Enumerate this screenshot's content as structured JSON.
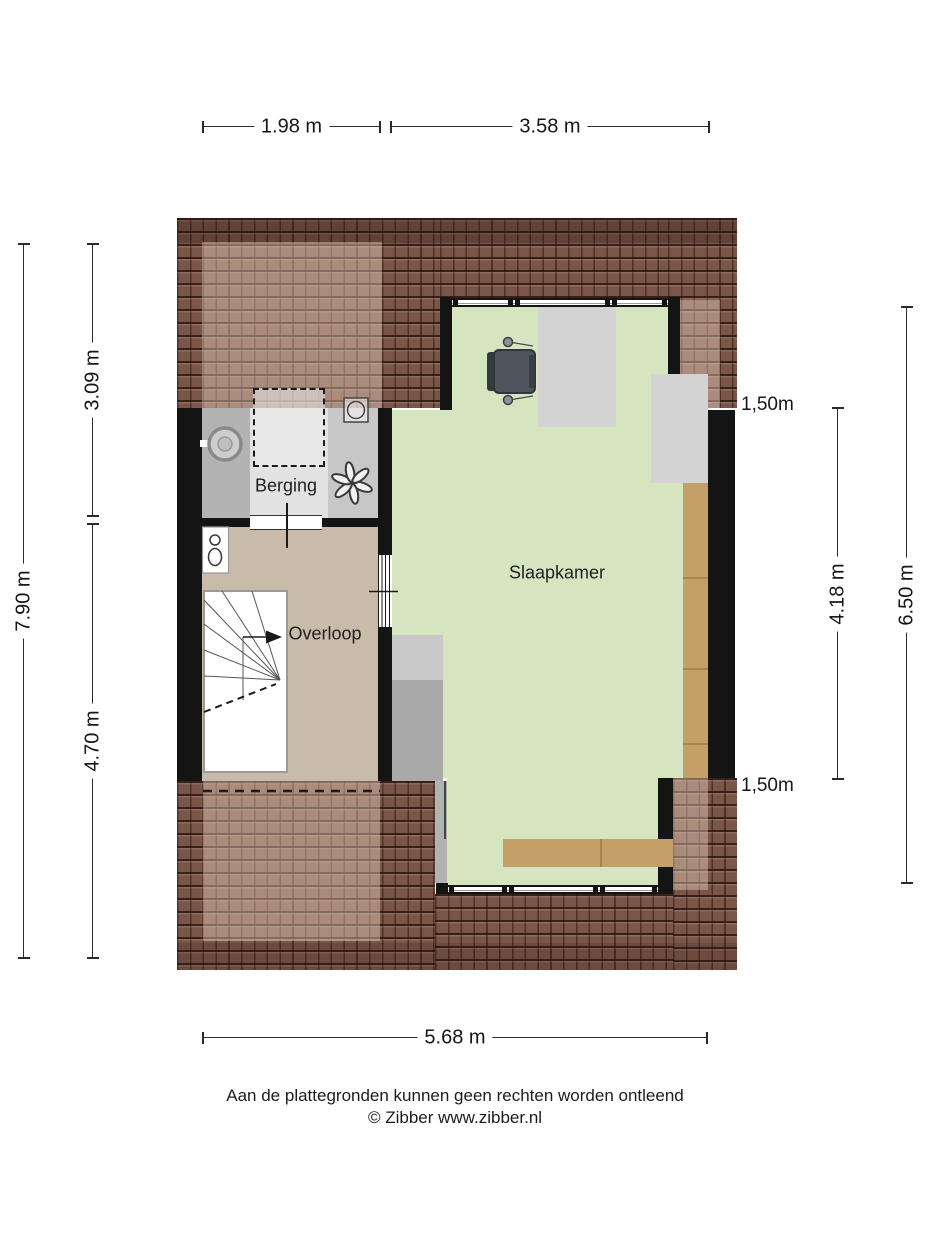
{
  "plan": {
    "type": "floorplan-second-floor",
    "rooms": [
      {
        "id": "berging",
        "label": "Berging"
      },
      {
        "id": "overloop",
        "label": "Overloop"
      },
      {
        "id": "slaapkamer",
        "label": "Slaapkamer"
      }
    ],
    "fixtures": [
      "washing-machine",
      "storage-hatch-dashed",
      "mechanical-ventilation-fan",
      "boiler-unit",
      "toilet",
      "winder-staircase",
      "stair-direction-arrow",
      "office-chair",
      "wardrobe",
      "desk",
      "dormer-window-top",
      "dormer-window-bottom",
      "interior-glass-door",
      "headroom-dashed-line"
    ]
  },
  "dimensions": {
    "top": [
      {
        "label": "1.98 m"
      },
      {
        "label": "3.58 m"
      }
    ],
    "left": [
      {
        "label": "7.90 m"
      },
      {
        "label": "3.09 m"
      },
      {
        "label": "4.70 m"
      }
    ],
    "right": [
      {
        "label": "4.18 m"
      },
      {
        "label": "6.50 m"
      }
    ],
    "bottom": [
      {
        "label": "5.68 m"
      }
    ],
    "height_markers": [
      {
        "label": "1,50m"
      },
      {
        "label": "1,50m"
      }
    ]
  },
  "footer": {
    "disclaimer": "Aan de plattegronden kunnen geen rechten worden ontleend",
    "credit": "© Zibber www.zibber.nl"
  },
  "colors": {
    "roof": "#7a5648",
    "wall": "#141414",
    "bedroom_floor": "#d5e5bf",
    "landing_floor": "#c9bbaa",
    "storage_floor": "#b3b3b3",
    "storage_floor_light": "#e2e2e2",
    "gray_patch": "#d3d3d3",
    "wood": "#c2a067"
  }
}
